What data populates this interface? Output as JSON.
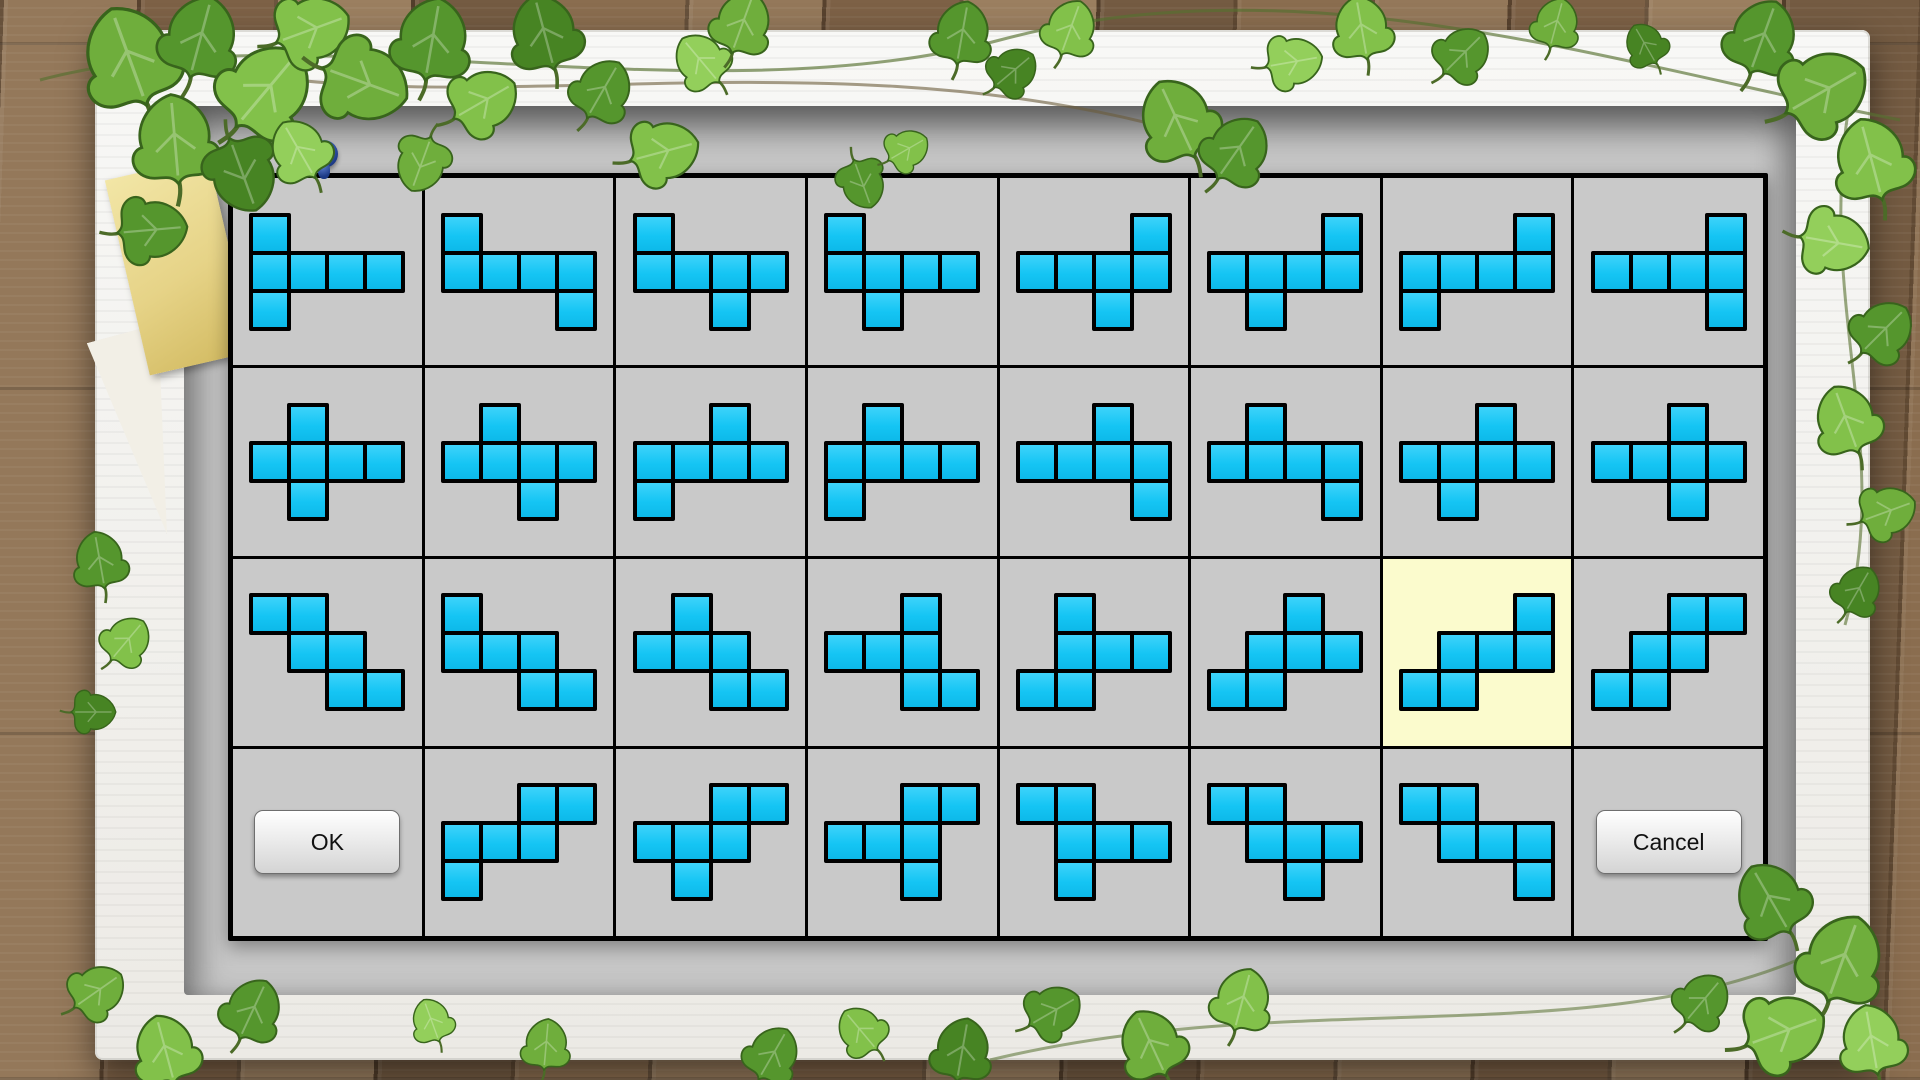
{
  "dialog": {
    "grid": {
      "rows": 4,
      "cols": 8
    },
    "selected_cell": {
      "row": 2,
      "col": 6
    },
    "buttons": {
      "ok": "OK",
      "cancel": "Cancel"
    },
    "colors": {
      "shape_fill": "#15C5F4",
      "shape_border": "#000000",
      "cell_bg": "#C9C9C9",
      "selected_bg": "#FBFBCD",
      "grid_border": "#000000",
      "well_bg": "#C6C6C6",
      "frame": "#F4F3EF",
      "wood": "#86694C",
      "leaf_green": "#5E9A33",
      "note_yellow": "#E8D588",
      "pin_blue": "#2A4A9E"
    },
    "shapes": [
      {
        "row": 0,
        "col": 0,
        "pattern": [
          "X...",
          "XXXX",
          "X..."
        ]
      },
      {
        "row": 0,
        "col": 1,
        "pattern": [
          "X...",
          "XXXX",
          "...X"
        ]
      },
      {
        "row": 0,
        "col": 2,
        "pattern": [
          "X...",
          "XXXX",
          "..X."
        ]
      },
      {
        "row": 0,
        "col": 3,
        "pattern": [
          "X...",
          "XXXX",
          ".X.."
        ]
      },
      {
        "row": 0,
        "col": 4,
        "pattern": [
          "...X",
          "XXXX",
          "..X."
        ]
      },
      {
        "row": 0,
        "col": 5,
        "pattern": [
          "...X",
          "XXXX",
          ".X.."
        ]
      },
      {
        "row": 0,
        "col": 6,
        "pattern": [
          "...X",
          "XXXX",
          "X..."
        ]
      },
      {
        "row": 0,
        "col": 7,
        "pattern": [
          "...X",
          "XXXX",
          "...X"
        ]
      },
      {
        "row": 1,
        "col": 0,
        "pattern": [
          ".X..",
          "XXXX",
          ".X.."
        ]
      },
      {
        "row": 1,
        "col": 1,
        "pattern": [
          ".X..",
          "XXXX",
          "..X."
        ]
      },
      {
        "row": 1,
        "col": 2,
        "pattern": [
          "..X.",
          "XXXX",
          "X..."
        ]
      },
      {
        "row": 1,
        "col": 3,
        "pattern": [
          ".X..",
          "XXXX",
          "X..."
        ]
      },
      {
        "row": 1,
        "col": 4,
        "pattern": [
          "..X.",
          "XXXX",
          "...X"
        ]
      },
      {
        "row": 1,
        "col": 5,
        "pattern": [
          ".X..",
          "XXXX",
          "...X"
        ]
      },
      {
        "row": 1,
        "col": 6,
        "pattern": [
          "..X.",
          "XXXX",
          ".X.."
        ]
      },
      {
        "row": 1,
        "col": 7,
        "pattern": [
          "..X.",
          "XXXX",
          "..X."
        ]
      },
      {
        "row": 2,
        "col": 0,
        "pattern": [
          "XX..",
          ".XX.",
          "..XX"
        ]
      },
      {
        "row": 2,
        "col": 1,
        "pattern": [
          "X...",
          "XXX.",
          "..XX"
        ]
      },
      {
        "row": 2,
        "col": 2,
        "pattern": [
          ".X..",
          "XXX.",
          "..XX"
        ]
      },
      {
        "row": 2,
        "col": 3,
        "pattern": [
          "..X.",
          "XXX.",
          "..XX"
        ]
      },
      {
        "row": 2,
        "col": 4,
        "pattern": [
          ".X..",
          ".XXX",
          "XX.."
        ]
      },
      {
        "row": 2,
        "col": 5,
        "pattern": [
          "..X.",
          ".XXX",
          "XX.."
        ]
      },
      {
        "row": 2,
        "col": 6,
        "pattern": [
          "...X",
          ".XXX",
          "XX.."
        ]
      },
      {
        "row": 2,
        "col": 7,
        "pattern": [
          "..XX",
          ".XX.",
          "XX.."
        ]
      },
      {
        "row": 3,
        "col": 1,
        "pattern": [
          "..XX",
          "XXX.",
          "X..."
        ]
      },
      {
        "row": 3,
        "col": 2,
        "pattern": [
          "..XX",
          "XXX.",
          ".X.."
        ]
      },
      {
        "row": 3,
        "col": 3,
        "pattern": [
          "..XX",
          "XXX.",
          "..X."
        ]
      },
      {
        "row": 3,
        "col": 4,
        "pattern": [
          "XX..",
          ".XXX",
          ".X.."
        ]
      },
      {
        "row": 3,
        "col": 5,
        "pattern": [
          "XX..",
          ".XXX",
          "..X."
        ]
      },
      {
        "row": 3,
        "col": 6,
        "pattern": [
          "XX..",
          ".XXX",
          "...X"
        ]
      }
    ]
  }
}
